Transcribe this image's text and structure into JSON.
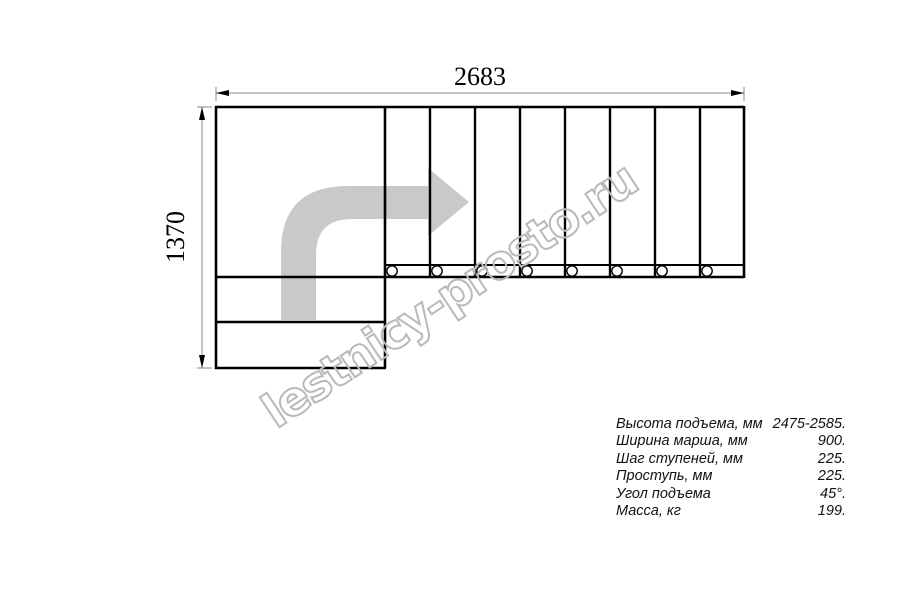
{
  "drawing": {
    "width_dimension": "2683",
    "height_dimension": "1370",
    "tread_count": 8,
    "lower_step_count": 2,
    "baluster_count": 8
  },
  "watermark": {
    "text": "lestnicy-prosto.ru"
  },
  "specs": {
    "rows": [
      {
        "label": "Высота подъема, мм",
        "value": "2475-2585."
      },
      {
        "label": "Ширина марша, мм",
        "value": "900."
      },
      {
        "label": "Шаг ступеней, мм",
        "value": "225."
      },
      {
        "label": "Проступь, мм",
        "value": "225."
      },
      {
        "label": "Угол подъема",
        "value": "45°."
      },
      {
        "label": "Масса, кг",
        "value": "199."
      }
    ]
  },
  "colors": {
    "line": "#000000",
    "dimension_line": "#888888",
    "direction_arrow": "#c9c9c9",
    "watermark_outline": "#b9b9b9"
  }
}
